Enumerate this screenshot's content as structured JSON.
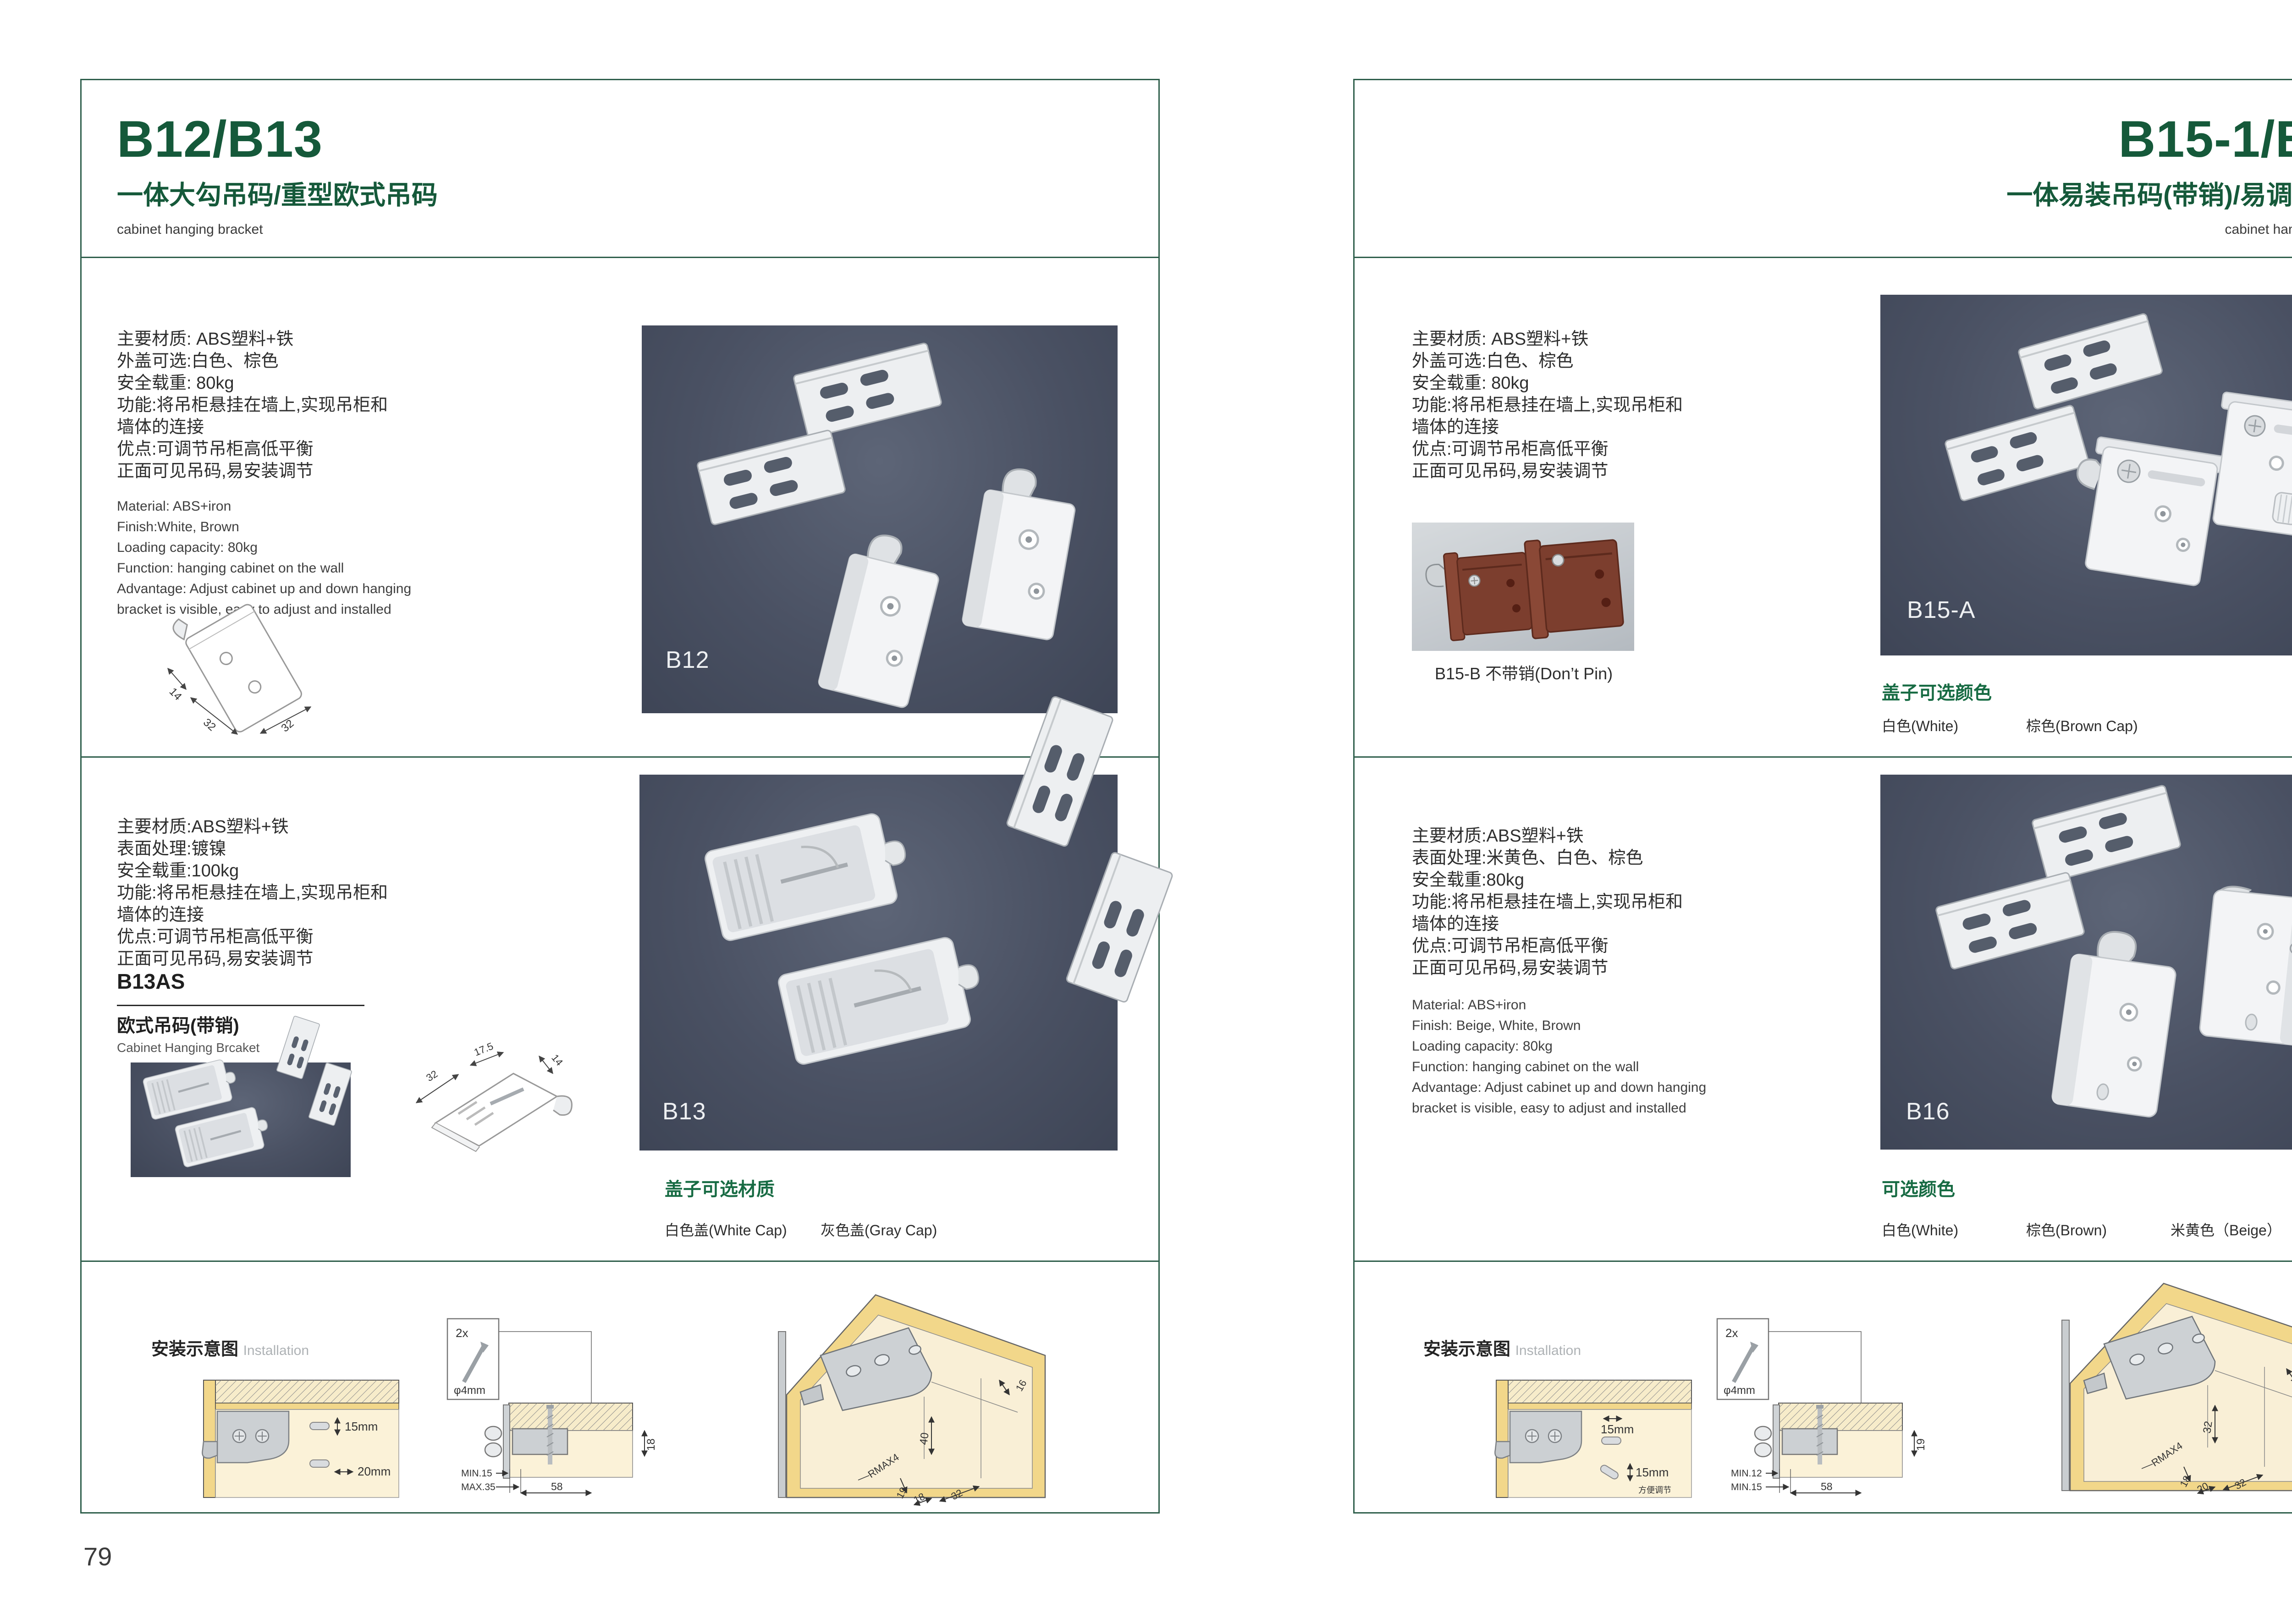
{
  "colors": {
    "accent_green": "#15593a",
    "caption_green": "#176b43",
    "border_green": "#2f5f4c",
    "photo_dark": "#4a5163",
    "photo_light": "#c9cdd2"
  },
  "left": {
    "title": "B12/B13",
    "subtitle": "一体大勾吊码/重型欧式吊码",
    "category": "cabinet hanging bracket",
    "page_no": "79",
    "s1_cn": [
      "主要材质: ABS塑料+铁",
      "外盖可选:白色、棕色",
      "安全载重: 80kg",
      "功能:将吊柜悬挂在墙上,实现吊柜和",
      "墙体的连接",
      "优点:可调节吊柜高低平衡",
      "正面可见吊码,易安装调节"
    ],
    "s1_en": [
      "Material: ABS+iron",
      "Finish:White, Brown",
      "Loading capacity: 80kg",
      "Function: hanging cabinet on the wall",
      "Advantage: Adjust cabinet up and down hanging",
      "bracket is visible, easy to adjust and installed"
    ],
    "s1_photo_label": "B12",
    "s1_dims": {
      "a": "14",
      "b": "32",
      "c": "32"
    },
    "s2_cn": [
      "主要材质:ABS塑料+铁",
      "表面处理:镀镍",
      "安全载重:100kg",
      "功能:将吊柜悬挂在墙上,实现吊柜和",
      "墙体的连接",
      "优点:可调节吊柜高低平衡",
      "正面可见吊码,易安装调节"
    ],
    "s2_model": "B13AS",
    "s2_model_cn": "欧式吊码(带销)",
    "s2_model_en": "Cabinet Hanging Brcaket",
    "s2_photo_label": "B13",
    "s2_dims": {
      "a": "32",
      "b": "17.5",
      "c": "14"
    },
    "s2_cap_title": "盖子可选材质",
    "s2_cap_opts": [
      "白色盖(White Cap)",
      "灰色盖(Gray Cap)"
    ],
    "install_title": "安装示意图",
    "install_en": "Installation",
    "d1": {
      "dim1": "15mm",
      "dim2": "20mm"
    },
    "d2": {
      "qty": "2x",
      "dia": "φ4mm",
      "side": "18",
      "l1": "MIN.15",
      "l2": "MAX.35",
      "w": "58"
    },
    "d3": {
      "a": "16",
      "b": "40",
      "c": "RMAX4",
      "d": "19",
      "e": "18",
      "f": "32"
    }
  },
  "right": {
    "title": "B15-1/B16",
    "subtitle": "一体易装吊码(带销)/易调节吊码",
    "category": "cabinet hanging bracket",
    "page_no": "80",
    "s1_cn": [
      "主要材质: ABS塑料+铁",
      "外盖可选:白色、棕色",
      "安全载重: 80kg",
      "功能:将吊柜悬挂在墙上,实现吊柜和",
      "墙体的连接",
      "优点:可调节吊柜高低平衡",
      "正面可见吊码,易安装调节"
    ],
    "s1_sub_caption": "B15-B 不带销(Don’t Pin)",
    "s1_photo_label": "B15-A",
    "s1_cap_title": "盖子可选颜色",
    "s1_cap_opts": [
      "白色(White)",
      "棕色(Brown Cap)"
    ],
    "s2_cn": [
      "主要材质:ABS塑料+铁",
      "表面处理:米黄色、白色、棕色",
      "安全载重:80kg",
      "功能:将吊柜悬挂在墙上,实现吊柜和",
      "墙体的连接",
      "优点:可调节吊柜高低平衡",
      "正面可见吊码,易安装调节"
    ],
    "s2_en": [
      "Material: ABS+iron",
      "Finish: Beige, White, Brown",
      "Loading capacity: 80kg",
      "Function: hanging cabinet on the wall",
      "Advantage: Adjust cabinet up and down hanging",
      "bracket is visible, easy to adjust and installed"
    ],
    "s2_photo_label": "B16",
    "s2_cap_title": "可选颜色",
    "s2_cap_opts": [
      "白色(White)",
      "棕色(Brown)",
      "米黄色（Beige）"
    ],
    "install_title": "安装示意图",
    "install_en": "Installation",
    "d1": {
      "dim1": "15mm",
      "dim2": "15mm",
      "note": "方便调节"
    },
    "d2": {
      "qty": "2x",
      "dia": "φ4mm",
      "side": "19",
      "l1": "MIN.12",
      "l2": "MIN.15",
      "w": "58"
    },
    "d3": {
      "a": "30",
      "b": "32",
      "c": "RMAX4",
      "d": "18",
      "e": "20",
      "f": "32"
    }
  }
}
